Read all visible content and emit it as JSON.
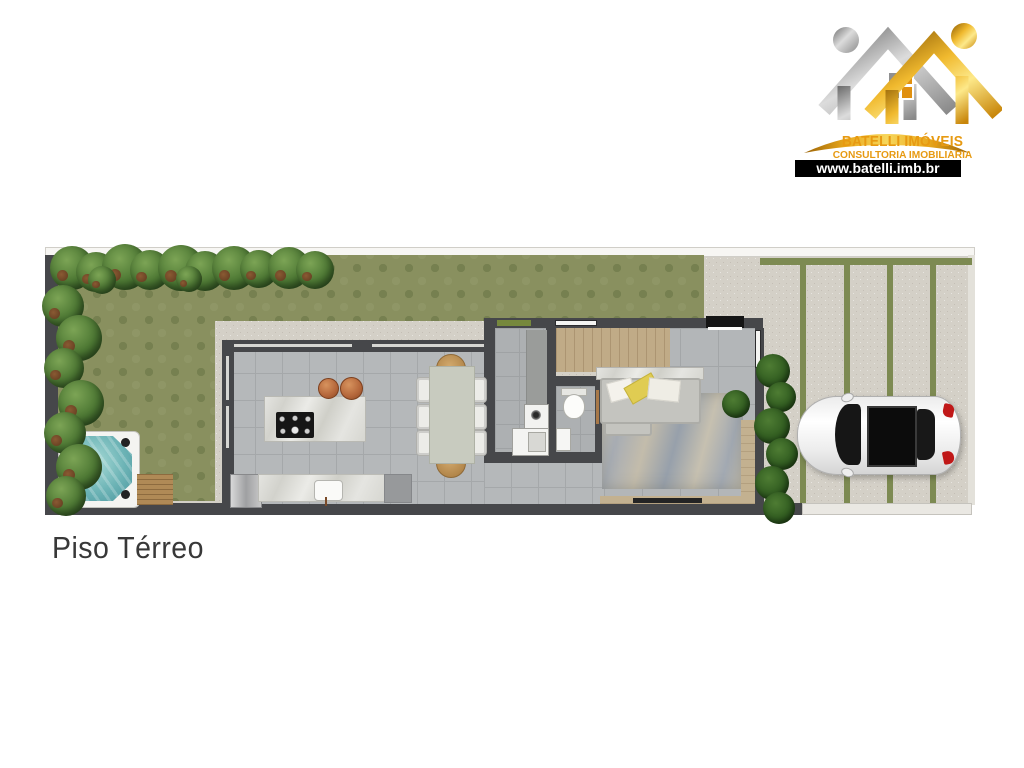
{
  "logo": {
    "company": "BATELLI IMÓVEIS",
    "tagline": "CONSULTORIA IMOBILIÁRIA",
    "website": "www.batelli.imb.br",
    "colors": {
      "gold": "#E79A12",
      "gold_deep": "#9A6206",
      "silver": "#A8A8A8",
      "bar_background": "#000000",
      "bar_text": "#FFFFFF"
    }
  },
  "floor_plan": {
    "caption": "Piso Térreo",
    "colors": {
      "grass": "#89905F",
      "concrete": "#D4D0C7",
      "tile_floor": "#B5B8BA",
      "wall": "#46474A",
      "wood_deck": "#B08A56",
      "spa_water": "#6DB4B6",
      "marble": "#DCDCD8",
      "sofa": "#C4C4BF",
      "accent_pillow": "#E0CC52",
      "driveway_strip": "#7D8A52",
      "car_body": "#FFFFFF",
      "taillight": "#C01818"
    },
    "areas": [
      "garden",
      "kitchen",
      "dining-area",
      "laundry",
      "bathroom",
      "entry-hall",
      "living-room",
      "driveway"
    ],
    "features": [
      "trees",
      "hot-tub",
      "wood-deck",
      "refrigerator",
      "kitchen-island",
      "cooktop",
      "sink",
      "dining-table",
      "washer",
      "laundry-tank",
      "toilet",
      "sofa",
      "rug",
      "tv-console",
      "plants",
      "parked-car"
    ]
  }
}
